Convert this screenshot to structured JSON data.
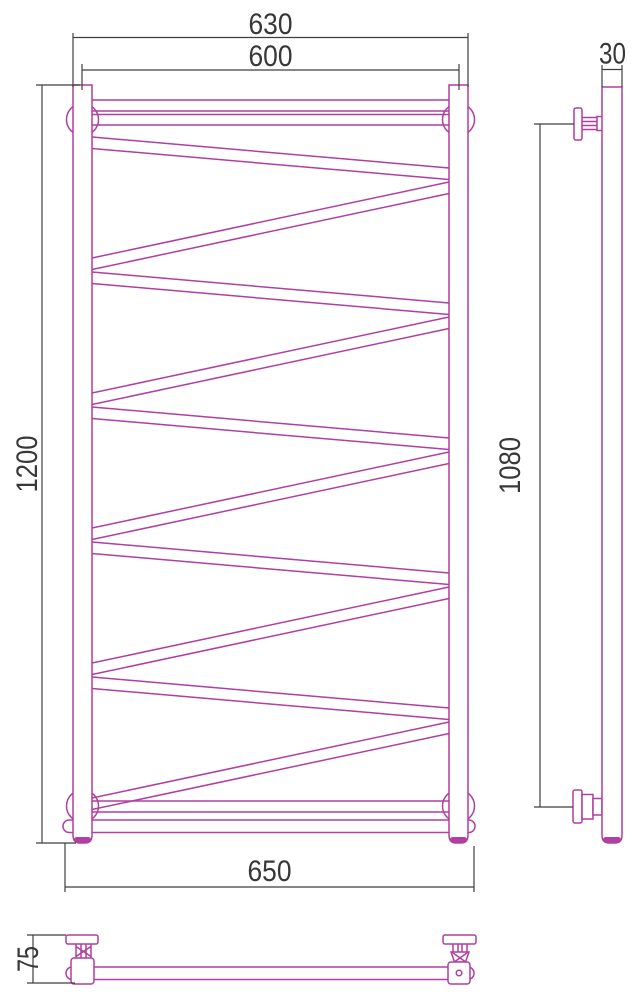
{
  "title": "Heated towel rail technical drawing",
  "colors": {
    "line": "#b03fa0",
    "dimension": "#3f3f3f",
    "background": "#ffffff",
    "text": "#383838"
  },
  "views": {
    "front": {
      "name": "front view",
      "crossbar_count": 10,
      "dims": {
        "overall_width": "630",
        "rail_spacing": "600",
        "height": "1200",
        "bottom_bar_width": "650"
      }
    },
    "side": {
      "name": "side view",
      "dims": {
        "tube_depth": "30",
        "bracket_span": "1080"
      }
    },
    "bottom": {
      "name": "bottom view",
      "dims": {
        "wall_offset": "75"
      }
    }
  }
}
